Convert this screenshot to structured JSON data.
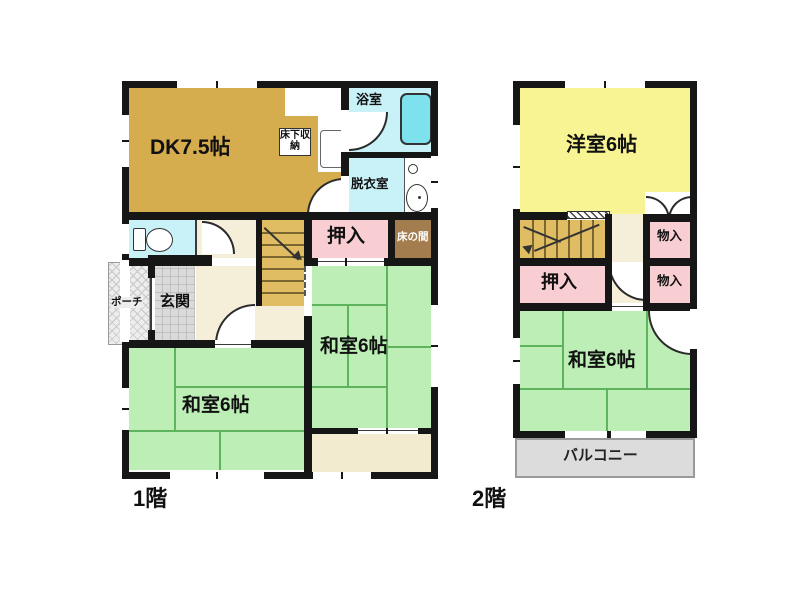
{
  "floor1": {
    "floor_label": "1階",
    "rooms": {
      "dk": "DK7.5帖",
      "underfloor_storage": "床下収納",
      "bath": "浴室",
      "dressing": "脱衣室",
      "oshiire": "押入",
      "tokonoma": "床の間",
      "washitsu_east": "和室6帖",
      "washitsu_south": "和室6帖",
      "genkan": "玄関",
      "porch": "ポーチ"
    }
  },
  "floor2": {
    "floor_label": "2階",
    "rooms": {
      "yoshitsu": "洋室6帖",
      "monoire_upper": "物入",
      "monoire_lower": "物入",
      "oshiire": "押入",
      "washitsu": "和室6帖",
      "balcony": "バルコニー"
    }
  },
  "colors": {
    "wall": "#161616",
    "dk": "#d5ac4e",
    "tatami_green": "#bceeb6",
    "tatami_line": "#5db45d",
    "western_yellow": "#f8f494",
    "closet_pink": "#f8ced3",
    "tokonoma_brown": "#a37d4e",
    "stairs_tan": "#e0bd63",
    "wet_area_cyan": "#c9f1f8",
    "bathtub": "#7de2ee",
    "hall_cream": "#f5efda",
    "genkan_gray": "#dadada",
    "balcony_gray": "#dcdcdc"
  }
}
